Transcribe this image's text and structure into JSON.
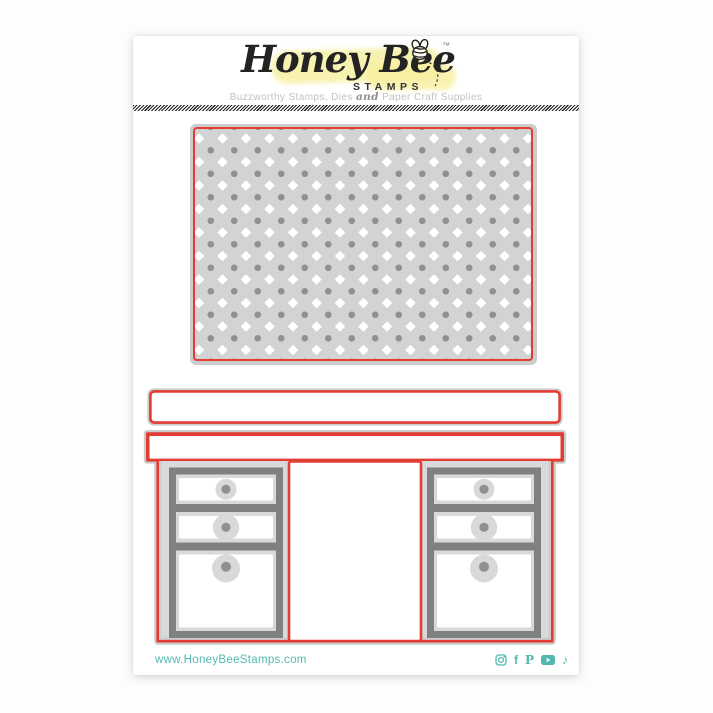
{
  "header": {
    "logo_script": "Honey Bee",
    "logo_sub": "STAMPS",
    "trademark": "™",
    "tagline_part1": "Buzzworthy Stamps, Dies ",
    "tagline_and": "and",
    "tagline_part2": " Paper Craft Supplies"
  },
  "footer": {
    "website": "www.HoneyBeeStamps.com",
    "social_icons": [
      "instagram-icon",
      "facebook-icon",
      "pinterest-icon",
      "youtube-icon",
      "tiktok-icon"
    ],
    "facebook_glyph": "f",
    "pinterest_glyph": "P",
    "tiktok_glyph": "♪"
  },
  "colors": {
    "die_cut_red": "#e23c33",
    "die_gray": "#d8d9da",
    "rim_gray": "#cbcccc",
    "panel_bg": "#d2d3d4",
    "frame_gray": "#7e8081",
    "dot_gray": "#8f9092",
    "teal": "#52b9b0",
    "tagline_gray": "#c2c2c2",
    "highlight_yellow": "#f7ef9e"
  },
  "pattern_panel": {
    "spacing": 23.5,
    "diamond_size": 7.4,
    "diamond_offset_x": 4,
    "diamond_offset_y": 9.5,
    "dot_radius": 3.3,
    "dot_offset_x": 15.75,
    "dot_offset_y": 21.25,
    "diamond_color": "#ffffff",
    "dot_color": "#8f9092",
    "width": 336,
    "height": 230
  }
}
